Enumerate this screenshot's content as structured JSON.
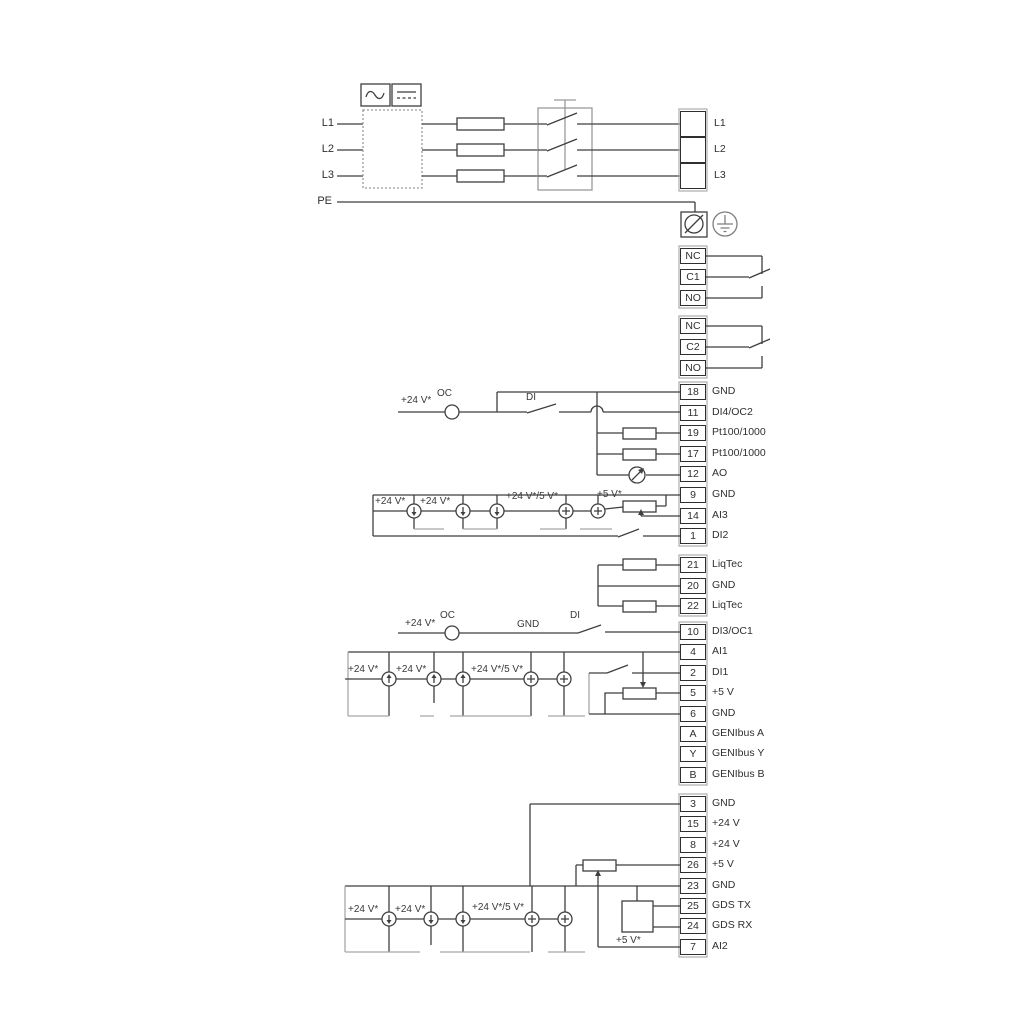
{
  "colors": {
    "wire": "#3f3f3f",
    "wire_alt": "#a8a8a8",
    "background": "#ffffff"
  },
  "power_input": {
    "l1": "L1",
    "l2": "L2",
    "l3": "L3",
    "pe": "PE"
  },
  "mains_out": [
    {
      "no": "",
      "label": "L1"
    },
    {
      "no": "",
      "label": "L2"
    },
    {
      "no": "",
      "label": "L3"
    }
  ],
  "relay1": [
    {
      "no": "NC",
      "label": ""
    },
    {
      "no": "C1",
      "label": ""
    },
    {
      "no": "NO",
      "label": ""
    }
  ],
  "relay2": [
    {
      "no": "NC",
      "label": ""
    },
    {
      "no": "C2",
      "label": ""
    },
    {
      "no": "NO",
      "label": ""
    }
  ],
  "io_a": [
    {
      "no": "18",
      "label": "GND"
    },
    {
      "no": "11",
      "label": "DI4/OC2"
    },
    {
      "no": "19",
      "label": "Pt100/1000"
    },
    {
      "no": "17",
      "label": "Pt100/1000"
    },
    {
      "no": "12",
      "label": "AO"
    },
    {
      "no": "9",
      "label": "GND"
    },
    {
      "no": "14",
      "label": "AI3"
    },
    {
      "no": "1",
      "label": "DI2"
    }
  ],
  "io_b": [
    {
      "no": "21",
      "label": "LiqTec"
    },
    {
      "no": "20",
      "label": "GND"
    },
    {
      "no": "22",
      "label": "LiqTec"
    }
  ],
  "io_c": [
    {
      "no": "10",
      "label": "DI3/OC1"
    },
    {
      "no": "4",
      "label": "AI1"
    },
    {
      "no": "2",
      "label": "DI1"
    },
    {
      "no": "5",
      "label": "+5 V"
    },
    {
      "no": "6",
      "label": "GND"
    },
    {
      "no": "A",
      "label": "GENIbus A"
    },
    {
      "no": "Y",
      "label": "GENIbus Y"
    },
    {
      "no": "B",
      "label": "GENIbus B"
    }
  ],
  "io_d": [
    {
      "no": "3",
      "label": "GND"
    },
    {
      "no": "15",
      "label": "+24 V"
    },
    {
      "no": "8",
      "label": "+24 V"
    },
    {
      "no": "26",
      "label": "+5 V"
    },
    {
      "no": "23",
      "label": "GND"
    },
    {
      "no": "25",
      "label": "GDS TX"
    },
    {
      "no": "24",
      "label": "GDS RX"
    },
    {
      "no": "7",
      "label": "AI2"
    }
  ],
  "labels": {
    "plus24": "+24 V*",
    "plus24or5": "+24 V*/5 V*",
    "plus5": "+5 V*",
    "oc": "OC",
    "di": "DI",
    "gnd": "GND"
  },
  "symbols": {
    "ac_icon": "sine-wave",
    "dc_icon": "dc-lines",
    "screw_terminal_icon": "circle-slash",
    "earth_icon": "protective-earth"
  }
}
